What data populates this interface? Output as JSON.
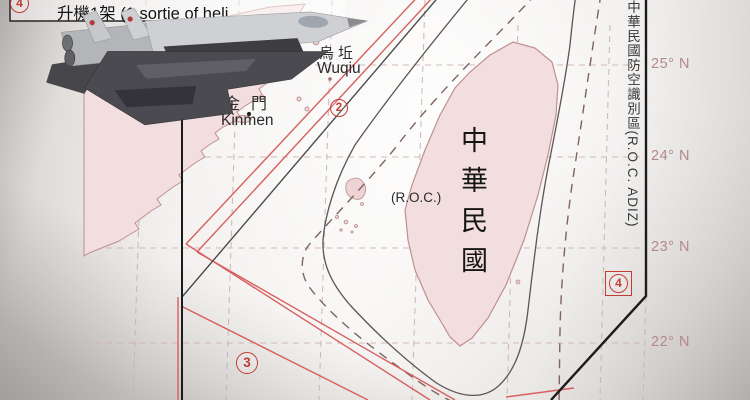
{
  "map": {
    "caption": {
      "text": "升機1架 (1 sortie of heli"
    },
    "labels": {
      "wuqiu_zh": "烏坵",
      "wuqiu_en": "Wuqiu",
      "kinmen_zh": "金門",
      "kinmen_en": "Kinmen",
      "taiwan_name_vertical": "中華民國",
      "taiwan_name_latin": "(R.O.C.)",
      "adiz_vertical": "中華民國防空識別區(R.O.C. ADIZ)"
    },
    "latitude_labels": [
      "25° N",
      "24° N",
      "23° N",
      "22° N"
    ],
    "markers": {
      "top_left": "4",
      "taiwan_strait_north": "2",
      "taiwan_strait_south": "3",
      "southeast": "4"
    },
    "colors": {
      "land_pink": "#f2dede",
      "coastline": "#c08f8f",
      "route_red": "#d65f5f",
      "median_line_dark": "#4b4b4b",
      "adiz_boundary_black": "#1c1c1c",
      "graticule_pink": "#cdb3b3",
      "marker_red": "#c43b33",
      "latitude_label": "#b48989"
    },
    "overlay": {
      "jet_image": "chinese-fighter-jet-photo"
    }
  }
}
